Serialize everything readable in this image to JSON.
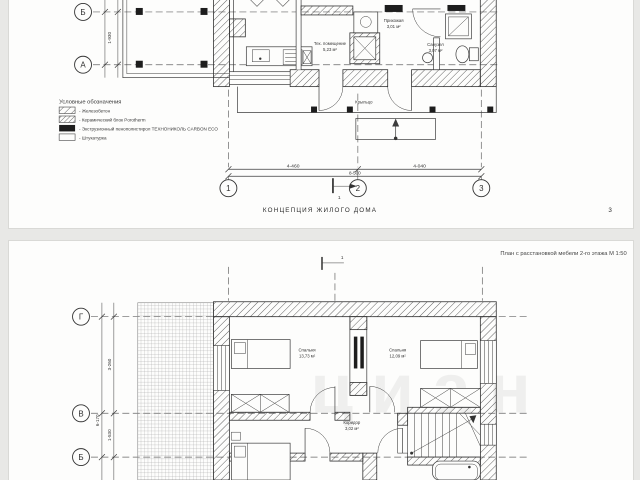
{
  "page1": {
    "axis_rows": {
      "r1": "Б",
      "r2": "А"
    },
    "left_dim": "1-930",
    "legend": {
      "title": "Условные обозначения",
      "items": [
        {
          "swatch": "hatch",
          "label": "- Железобетон"
        },
        {
          "swatch": "hatch-dense",
          "label": "- Керамический блок Porotherm"
        },
        {
          "swatch": "solid-black",
          "label": "- Экструзионный пенополистирол ТЕХНОНИКОЛЬ CARBON ECO"
        },
        {
          "swatch": "empty",
          "label": "- Штукатурка"
        }
      ]
    },
    "rooms": {
      "tech": {
        "name": "Тех. помещение",
        "area": "5,23 м²"
      },
      "hall": {
        "name": "Прихожая",
        "area": "3,01 м²"
      },
      "bath": {
        "name": "Санузел",
        "area": "3,07 м²"
      },
      "porch": {
        "name": "Крыльцо"
      }
    },
    "dims": {
      "seg1": "4-460",
      "seg2": "4-040",
      "total": "8-500"
    },
    "axis_cols": {
      "c1": "1",
      "c2": "2",
      "c3": "3"
    },
    "section_mark": "1",
    "caption": "КОНЦЕПЦИЯ ЖИЛОГО ДОМА",
    "page_number": "3"
  },
  "page2": {
    "header": "План с расстановкой мебели 2-го этажа М 1:50",
    "axis_rows": {
      "r1": "Г",
      "r2": "В",
      "r3": "Б"
    },
    "dims": {
      "seg1": "3-260",
      "seg2": "1-530",
      "total": "6-170"
    },
    "rooms": {
      "bedroom1": {
        "name": "Спальня",
        "area": "13,73 м²"
      },
      "bedroom2": {
        "name": "Спальня",
        "area": "12,09 м²"
      },
      "corridor": {
        "name": "Коридор",
        "area": "3,02 м²"
      }
    },
    "section_mark": "1",
    "watermark": "циан"
  }
}
